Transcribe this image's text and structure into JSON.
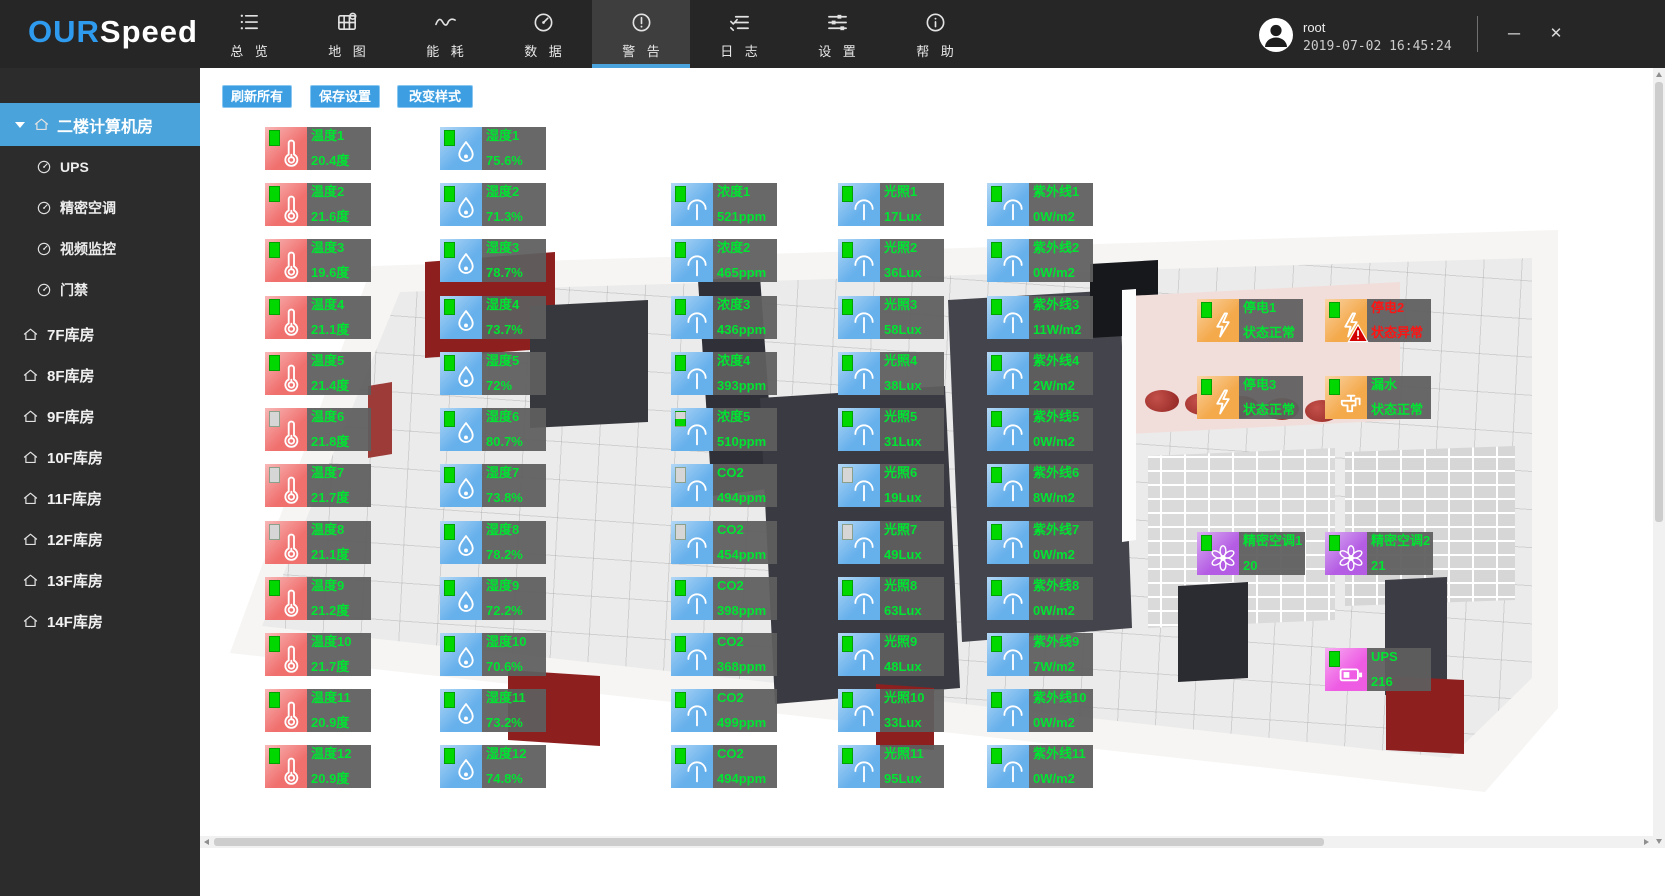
{
  "brand": {
    "blue": "OUR",
    "white": "Speed"
  },
  "colors": {
    "accent": "#4aa3dc",
    "logo_blue": "#2f9bef",
    "button_blue": "#3d9fe2",
    "sidebar_active": "#4aa3da",
    "ok_green": "#00e432",
    "alarm_red": "#ff1414",
    "tile_temperature": "#f0706e",
    "tile_blue": "#66b0ec",
    "tile_orange": "#f4a94b",
    "tile_purple": "#b45ce4",
    "tile_pink": "#ee5ce4",
    "panel_gray": "#5f5f5f"
  },
  "topbar": {
    "nav": [
      {
        "id": "overview",
        "label": "总 览",
        "icon": "list",
        "active": false
      },
      {
        "id": "map",
        "label": "地 图",
        "icon": "map",
        "active": false
      },
      {
        "id": "energy",
        "label": "能 耗",
        "icon": "energy",
        "active": false
      },
      {
        "id": "data",
        "label": "数 据",
        "icon": "gauge",
        "active": false
      },
      {
        "id": "alerts",
        "label": "警 告",
        "icon": "alert",
        "active": true
      },
      {
        "id": "logs",
        "label": "日 志",
        "icon": "log",
        "active": false
      },
      {
        "id": "settings",
        "label": "设 置",
        "icon": "sliders",
        "active": false
      },
      {
        "id": "help",
        "label": "帮 助",
        "icon": "info",
        "active": false
      }
    ],
    "user": {
      "name": "root",
      "datetime": "2019-07-02 16:45:24"
    },
    "window_controls": {
      "minimize": "─",
      "close": "✕"
    }
  },
  "sidebar": {
    "active_room": {
      "label": "二楼计算机房",
      "children": [
        {
          "label": "UPS"
        },
        {
          "label": "精密空调"
        },
        {
          "label": "视频监控"
        },
        {
          "label": "门禁"
        }
      ]
    },
    "rooms": [
      {
        "label": "7F库房"
      },
      {
        "label": "8F库房"
      },
      {
        "label": "9F库房"
      },
      {
        "label": "10F库房"
      },
      {
        "label": "11F库房"
      },
      {
        "label": "12F库房"
      },
      {
        "label": "13F库房"
      },
      {
        "label": "14F库房"
      }
    ]
  },
  "toolbar": {
    "buttons": [
      {
        "label": "刷新所有"
      },
      {
        "label": "保存设置"
      },
      {
        "label": "改变样式"
      }
    ]
  },
  "sensor_types": {
    "temperature": {
      "icon": "thermometer",
      "tile": "#f0706e"
    },
    "humidity": {
      "icon": "droplet",
      "tile": "#66b0ec"
    },
    "co2": {
      "icon": "meter",
      "tile": "#66b0ec"
    },
    "light": {
      "icon": "meter",
      "tile": "#66b0ec"
    },
    "uv": {
      "icon": "meter",
      "tile": "#66b0ec"
    },
    "power": {
      "icon": "bolt",
      "tile": "#f4a94b"
    },
    "water": {
      "icon": "faucet",
      "tile": "#f4a94b"
    },
    "ac": {
      "icon": "fan",
      "tile": "#b45ce4"
    },
    "ups": {
      "icon": "battery",
      "tile": "#ee5ce4"
    }
  },
  "sensors": [
    {
      "type": "temperature",
      "label": "温度1",
      "value": "20.4度",
      "battery": "full",
      "x": 65,
      "y": 59
    },
    {
      "type": "temperature",
      "label": "温度2",
      "value": "21.6度",
      "battery": "full",
      "x": 65,
      "y": 115
    },
    {
      "type": "temperature",
      "label": "温度3",
      "value": "19.6度",
      "battery": "full",
      "x": 65,
      "y": 171
    },
    {
      "type": "temperature",
      "label": "温度4",
      "value": "21.1度",
      "battery": "full",
      "x": 65,
      "y": 228
    },
    {
      "type": "temperature",
      "label": "温度5",
      "value": "21.4度",
      "battery": "full",
      "x": 65,
      "y": 284
    },
    {
      "type": "temperature",
      "label": "温度6",
      "value": "21.8度",
      "battery": "empty",
      "x": 65,
      "y": 340
    },
    {
      "type": "temperature",
      "label": "温度7",
      "value": "21.7度",
      "battery": "empty",
      "x": 65,
      "y": 396
    },
    {
      "type": "temperature",
      "label": "温度8",
      "value": "21.1度",
      "battery": "empty",
      "x": 65,
      "y": 453
    },
    {
      "type": "temperature",
      "label": "温度9",
      "value": "21.2度",
      "battery": "full",
      "x": 65,
      "y": 509
    },
    {
      "type": "temperature",
      "label": "温度10",
      "value": "21.7度",
      "battery": "full",
      "x": 65,
      "y": 565
    },
    {
      "type": "temperature",
      "label": "温度11",
      "value": "20.9度",
      "battery": "full",
      "x": 65,
      "y": 621
    },
    {
      "type": "temperature",
      "label": "温度12",
      "value": "20.9度",
      "battery": "full",
      "x": 65,
      "y": 677
    },
    {
      "type": "humidity",
      "label": "湿度1",
      "value": "75.6%",
      "battery": "full",
      "x": 240,
      "y": 59
    },
    {
      "type": "humidity",
      "label": "湿度2",
      "value": "71.3%",
      "battery": "full",
      "x": 240,
      "y": 115
    },
    {
      "type": "humidity",
      "label": "湿度3",
      "value": "78.7%",
      "battery": "full",
      "x": 240,
      "y": 171
    },
    {
      "type": "humidity",
      "label": "湿度4",
      "value": "73.7%",
      "battery": "full",
      "x": 240,
      "y": 228
    },
    {
      "type": "humidity",
      "label": "湿度5",
      "value": "72%",
      "battery": "full",
      "x": 240,
      "y": 284
    },
    {
      "type": "humidity",
      "label": "湿度6",
      "value": "80.7%",
      "battery": "full",
      "x": 240,
      "y": 340
    },
    {
      "type": "humidity",
      "label": "湿度7",
      "value": "73.8%",
      "battery": "full",
      "x": 240,
      "y": 396
    },
    {
      "type": "humidity",
      "label": "湿度8",
      "value": "78.2%",
      "battery": "full",
      "x": 240,
      "y": 453
    },
    {
      "type": "humidity",
      "label": "湿度9",
      "value": "72.2%",
      "battery": "full",
      "x": 240,
      "y": 509
    },
    {
      "type": "humidity",
      "label": "湿度10",
      "value": "70.6%",
      "battery": "full",
      "x": 240,
      "y": 565
    },
    {
      "type": "humidity",
      "label": "湿度11",
      "value": "73.2%",
      "battery": "full",
      "x": 240,
      "y": 621
    },
    {
      "type": "humidity",
      "label": "湿度12",
      "value": "74.8%",
      "battery": "full",
      "x": 240,
      "y": 677
    },
    {
      "type": "co2",
      "label": "浓度1",
      "value": "521ppm",
      "battery": "full",
      "x": 471,
      "y": 115
    },
    {
      "type": "co2",
      "label": "浓度2",
      "value": "465ppm",
      "battery": "full",
      "x": 471,
      "y": 171
    },
    {
      "type": "co2",
      "label": "浓度3",
      "value": "436ppm",
      "battery": "full",
      "x": 471,
      "y": 228
    },
    {
      "type": "co2",
      "label": "浓度4",
      "value": "393ppm",
      "battery": "full",
      "x": 471,
      "y": 284
    },
    {
      "type": "co2",
      "label": "浓度5",
      "value": "510ppm",
      "battery": "half",
      "x": 471,
      "y": 340
    },
    {
      "type": "co2",
      "label": "CO2",
      "value": "494ppm",
      "battery": "empty",
      "x": 471,
      "y": 396
    },
    {
      "type": "co2",
      "label": "CO2",
      "value": "454ppm",
      "battery": "empty",
      "x": 471,
      "y": 453
    },
    {
      "type": "co2",
      "label": "CO2",
      "value": "398ppm",
      "battery": "full",
      "x": 471,
      "y": 509
    },
    {
      "type": "co2",
      "label": "CO2",
      "value": "368ppm",
      "battery": "full",
      "x": 471,
      "y": 565
    },
    {
      "type": "co2",
      "label": "CO2",
      "value": "499ppm",
      "battery": "full",
      "x": 471,
      "y": 621
    },
    {
      "type": "co2",
      "label": "CO2",
      "value": "494ppm",
      "battery": "full",
      "x": 471,
      "y": 677
    },
    {
      "type": "light",
      "label": "光照1",
      "value": "17Lux",
      "battery": "full",
      "x": 638,
      "y": 115
    },
    {
      "type": "light",
      "label": "光照2",
      "value": "36Lux",
      "battery": "full",
      "x": 638,
      "y": 171
    },
    {
      "type": "light",
      "label": "光照3",
      "value": "58Lux",
      "battery": "full",
      "x": 638,
      "y": 228
    },
    {
      "type": "light",
      "label": "光照4",
      "value": "38Lux",
      "battery": "full",
      "x": 638,
      "y": 284
    },
    {
      "type": "light",
      "label": "光照5",
      "value": "31Lux",
      "battery": "full",
      "x": 638,
      "y": 340
    },
    {
      "type": "light",
      "label": "光照6",
      "value": "19Lux",
      "battery": "empty",
      "x": 638,
      "y": 396
    },
    {
      "type": "light",
      "label": "光照7",
      "value": "49Lux",
      "battery": "empty",
      "x": 638,
      "y": 453
    },
    {
      "type": "light",
      "label": "光照8",
      "value": "63Lux",
      "battery": "full",
      "x": 638,
      "y": 509
    },
    {
      "type": "light",
      "label": "光照9",
      "value": "48Lux",
      "battery": "full",
      "x": 638,
      "y": 565
    },
    {
      "type": "light",
      "label": "光照10",
      "value": "33Lux",
      "battery": "full",
      "x": 638,
      "y": 621
    },
    {
      "type": "light",
      "label": "光照11",
      "value": "95Lux",
      "battery": "full",
      "x": 638,
      "y": 677
    },
    {
      "type": "uv",
      "label": "紫外线1",
      "value": "0W/m2",
      "battery": "full",
      "x": 787,
      "y": 115
    },
    {
      "type": "uv",
      "label": "紫外线2",
      "value": "0W/m2",
      "battery": "full",
      "x": 787,
      "y": 171
    },
    {
      "type": "uv",
      "label": "紫外线3",
      "value": "11W/m2",
      "battery": "full",
      "x": 787,
      "y": 228
    },
    {
      "type": "uv",
      "label": "紫外线4",
      "value": "2W/m2",
      "battery": "full",
      "x": 787,
      "y": 284
    },
    {
      "type": "uv",
      "label": "紫外线5",
      "value": "0W/m2",
      "battery": "full",
      "x": 787,
      "y": 340
    },
    {
      "type": "uv",
      "label": "紫外线6",
      "value": "8W/m2",
      "battery": "full",
      "x": 787,
      "y": 396
    },
    {
      "type": "uv",
      "label": "紫外线7",
      "value": "0W/m2",
      "battery": "full",
      "x": 787,
      "y": 453
    },
    {
      "type": "uv",
      "label": "紫外线8",
      "value": "0W/m2",
      "battery": "full",
      "x": 787,
      "y": 509
    },
    {
      "type": "uv",
      "label": "紫外线9",
      "value": "7W/m2",
      "battery": "full",
      "x": 787,
      "y": 565
    },
    {
      "type": "uv",
      "label": "紫外线10",
      "value": "0W/m2",
      "battery": "full",
      "x": 787,
      "y": 621
    },
    {
      "type": "uv",
      "label": "紫外线11",
      "value": "0W/m2",
      "battery": "full",
      "x": 787,
      "y": 677
    },
    {
      "type": "power",
      "label": "停电1",
      "value": "状态正常",
      "battery": "full",
      "x": 997,
      "y": 231
    },
    {
      "type": "power",
      "label": "停电2",
      "value": "状态异常",
      "battery": "full",
      "x": 1125,
      "y": 231,
      "alarm": true
    },
    {
      "type": "power",
      "label": "停电3",
      "value": "状态正常",
      "battery": "full",
      "x": 997,
      "y": 308
    },
    {
      "type": "water",
      "label": "漏水",
      "value": "状态正常",
      "battery": "full",
      "x": 1125,
      "y": 308
    },
    {
      "type": "ac",
      "label": "精密空调1",
      "value": "20",
      "battery": "full",
      "x": 997,
      "y": 464
    },
    {
      "type": "ac",
      "label": "精密空调2",
      "value": "21",
      "battery": "full",
      "x": 1125,
      "y": 464
    },
    {
      "type": "ups",
      "label": "UPS",
      "value": "216",
      "battery": "full",
      "x": 1125,
      "y": 580
    }
  ]
}
